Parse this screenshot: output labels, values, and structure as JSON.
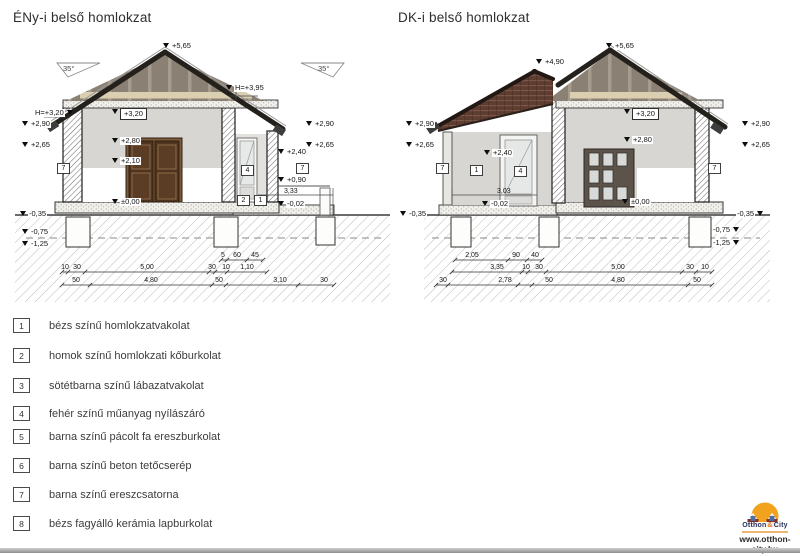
{
  "page": {
    "website": "www.otthon-city.hu"
  },
  "logo": {
    "name1": "Otthon",
    "amp": "&",
    "name2": "City"
  },
  "drawings": {
    "left": {
      "title": "ÉNy-i belső homlokzat",
      "slope_left": "35°",
      "slope_right": "35°",
      "annotations": [
        {
          "t": "+5,65",
          "x": 163,
          "y": 42,
          "k": "lvl"
        },
        {
          "t": "H=+3,95",
          "x": 226,
          "y": 84,
          "k": "lvl"
        },
        {
          "t": "H=+3,20",
          "x": 34,
          "y": 109,
          "k": "lvl",
          "s": "r"
        },
        {
          "t": "+2,90",
          "x": 22,
          "y": 120,
          "k": "lvl"
        },
        {
          "t": "+2,65",
          "x": 22,
          "y": 141,
          "k": "lvl"
        },
        {
          "t": "7",
          "x": 57,
          "y": 163,
          "k": "key"
        },
        {
          "t": "+3,20",
          "x": 112,
          "y": 108,
          "k": "lvlbox"
        },
        {
          "t": "+2,80",
          "x": 112,
          "y": 137,
          "k": "lvl"
        },
        {
          "t": "+2,10",
          "x": 112,
          "y": 157,
          "k": "lvl"
        },
        {
          "t": "±0,00",
          "x": 112,
          "y": 198,
          "k": "lvl"
        },
        {
          "t": "-0,35",
          "x": 20,
          "y": 210,
          "k": "lvl"
        },
        {
          "t": "-0,75",
          "x": 22,
          "y": 228,
          "k": "lvl"
        },
        {
          "t": "-1,25",
          "x": 22,
          "y": 240,
          "k": "lvl"
        },
        {
          "t": "+2,90",
          "x": 306,
          "y": 120,
          "k": "lvl"
        },
        {
          "t": "+2,65",
          "x": 306,
          "y": 141,
          "k": "lvl"
        },
        {
          "t": "+2,40",
          "x": 278,
          "y": 148,
          "k": "lvl"
        },
        {
          "t": "7",
          "x": 296,
          "y": 163,
          "k": "key"
        },
        {
          "t": "4",
          "x": 241,
          "y": 165,
          "k": "key"
        },
        {
          "t": "+0,90",
          "x": 278,
          "y": 176,
          "k": "lvl"
        },
        {
          "t": "3,33",
          "x": 284,
          "y": 188,
          "k": "txt"
        },
        {
          "t": "-0,02",
          "x": 278,
          "y": 200,
          "k": "lvl"
        },
        {
          "t": "2",
          "x": 237,
          "y": 195,
          "k": "key"
        },
        {
          "t": "1",
          "x": 254,
          "y": 195,
          "k": "key"
        },
        {
          "t": "5",
          "x": 223,
          "y": 252,
          "k": "dim"
        },
        {
          "t": "60",
          "x": 237,
          "y": 252,
          "k": "dim"
        },
        {
          "t": "45",
          "x": 255,
          "y": 252,
          "k": "dim"
        },
        {
          "t": "10",
          "x": 65,
          "y": 264,
          "k": "dim"
        },
        {
          "t": "30",
          "x": 77,
          "y": 264,
          "k": "dim"
        },
        {
          "t": "5,00",
          "x": 147,
          "y": 264,
          "k": "dim"
        },
        {
          "t": "30",
          "x": 212,
          "y": 264,
          "k": "dim"
        },
        {
          "t": "10",
          "x": 226,
          "y": 264,
          "k": "dim"
        },
        {
          "t": "1,10",
          "x": 247,
          "y": 264,
          "k": "dim"
        },
        {
          "t": "50",
          "x": 76,
          "y": 277,
          "k": "dim"
        },
        {
          "t": "4,80",
          "x": 151,
          "y": 277,
          "k": "dim"
        },
        {
          "t": "50",
          "x": 219,
          "y": 277,
          "k": "dim"
        },
        {
          "t": "3,10",
          "x": 280,
          "y": 277,
          "k": "dim"
        },
        {
          "t": "30",
          "x": 324,
          "y": 277,
          "k": "dim"
        }
      ]
    },
    "right": {
      "title": "DK-i belső homlokzat",
      "annotations": [
        {
          "t": "+5,65",
          "x": 606,
          "y": 42,
          "k": "lvl"
        },
        {
          "t": "+4,90",
          "x": 536,
          "y": 58,
          "k": "lvl"
        },
        {
          "t": "+2,90",
          "x": 406,
          "y": 120,
          "k": "lvl"
        },
        {
          "t": "+2,65",
          "x": 406,
          "y": 141,
          "k": "lvl"
        },
        {
          "t": "7",
          "x": 436,
          "y": 163,
          "k": "key"
        },
        {
          "t": "1",
          "x": 470,
          "y": 165,
          "k": "key"
        },
        {
          "t": "+2,40",
          "x": 484,
          "y": 149,
          "k": "lvl"
        },
        {
          "t": "4",
          "x": 514,
          "y": 166,
          "k": "key"
        },
        {
          "t": "3,03",
          "x": 497,
          "y": 188,
          "k": "txt"
        },
        {
          "t": "-0,02",
          "x": 482,
          "y": 200,
          "k": "lvl"
        },
        {
          "t": "+3,20",
          "x": 624,
          "y": 108,
          "k": "lvlbox"
        },
        {
          "t": "+2,80",
          "x": 624,
          "y": 136,
          "k": "lvl"
        },
        {
          "t": "±0,00",
          "x": 622,
          "y": 198,
          "k": "lvl"
        },
        {
          "t": "7",
          "x": 708,
          "y": 163,
          "k": "key"
        },
        {
          "t": "+2,90",
          "x": 742,
          "y": 120,
          "k": "lvl"
        },
        {
          "t": "+2,65",
          "x": 742,
          "y": 141,
          "k": "lvl"
        },
        {
          "t": "-0,35",
          "x": 400,
          "y": 210,
          "k": "lvl"
        },
        {
          "t": "-0,35",
          "x": 736,
          "y": 210,
          "k": "lvl",
          "s": "r"
        },
        {
          "t": "-0,75",
          "x": 712,
          "y": 226,
          "k": "lvl",
          "s": "r"
        },
        {
          "t": "-1,25",
          "x": 712,
          "y": 239,
          "k": "lvl",
          "s": "r"
        },
        {
          "t": "2,05",
          "x": 472,
          "y": 252,
          "k": "dim"
        },
        {
          "t": "90",
          "x": 516,
          "y": 252,
          "k": "dim"
        },
        {
          "t": "40",
          "x": 535,
          "y": 252,
          "k": "dim"
        },
        {
          "t": "3,35",
          "x": 497,
          "y": 264,
          "k": "dim"
        },
        {
          "t": "10",
          "x": 526,
          "y": 264,
          "k": "dim"
        },
        {
          "t": "30",
          "x": 539,
          "y": 264,
          "k": "dim"
        },
        {
          "t": "5,00",
          "x": 618,
          "y": 264,
          "k": "dim"
        },
        {
          "t": "30",
          "x": 690,
          "y": 264,
          "k": "dim"
        },
        {
          "t": "10",
          "x": 705,
          "y": 264,
          "k": "dim"
        },
        {
          "t": "30",
          "x": 443,
          "y": 277,
          "k": "dim"
        },
        {
          "t": "2,78",
          "x": 505,
          "y": 277,
          "k": "dim"
        },
        {
          "t": "50",
          "x": 549,
          "y": 277,
          "k": "dim"
        },
        {
          "t": "4,80",
          "x": 618,
          "y": 277,
          "k": "dim"
        },
        {
          "t": "50",
          "x": 697,
          "y": 277,
          "k": "dim"
        }
      ]
    }
  },
  "legend": {
    "items": [
      {
        "num": "1",
        "label": "bézs színű homlokzatvakolat"
      },
      {
        "num": "2",
        "label": "homok színű homlokzati kőburkolat"
      },
      {
        "num": "3",
        "label": "sötétbarna színű lábazatvakolat"
      },
      {
        "num": "4",
        "label": "fehér színű műanyag nyílászáró"
      },
      {
        "num": "5",
        "label": "barna színű pácolt fa ereszburkolat"
      },
      {
        "num": "6",
        "label": "barna színű beton tetőcserép"
      },
      {
        "num": "7",
        "label": "barna színű ereszcsatorna"
      },
      {
        "num": "8",
        "label": "bézs fagyálló kerámia lapburkolat"
      }
    ]
  }
}
